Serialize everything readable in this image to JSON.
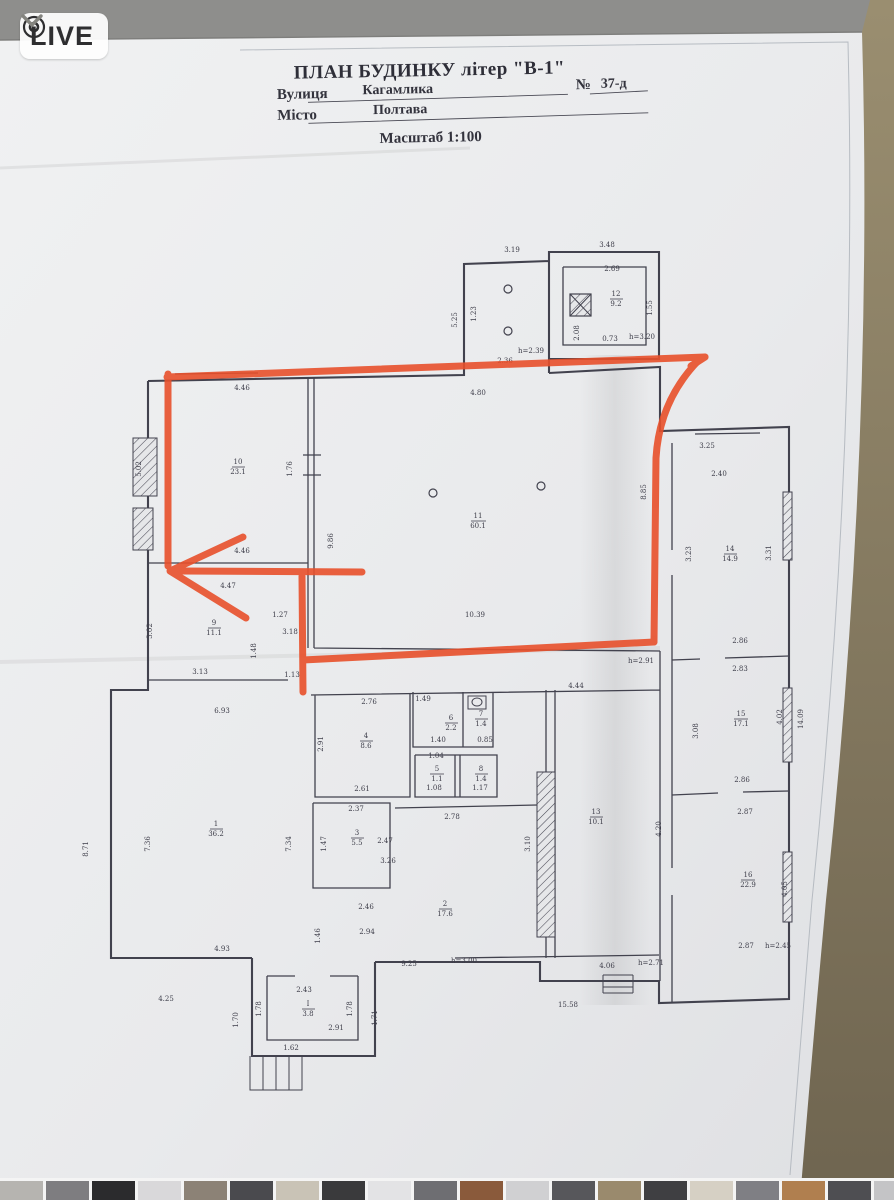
{
  "viewer": {
    "live_label": "LIVE"
  },
  "document": {
    "title": "ПЛАН БУДИНКУ літер \"В-1\"",
    "street_label": "Вулиця",
    "street_value": "Кагамлика",
    "number_label": "№",
    "number_value": "37-д",
    "city_label": "Місто",
    "city_value": "Полтава",
    "scale_label": "Масштаб 1:100"
  },
  "colors": {
    "marker": "#e8502b",
    "paper": "#eceded",
    "background_gray": "#8e8e8c",
    "background_tan": "#8a7d60",
    "ink": "#42424e"
  },
  "plan": {
    "labels": [
      {
        "t": "3.19",
        "x": 512,
        "y": 252
      },
      {
        "t": "3.48",
        "x": 607,
        "y": 247
      },
      {
        "t": "2.69",
        "x": 612,
        "y": 271
      },
      {
        "t": "5.25",
        "x": 457,
        "y": 320,
        "r": -90
      },
      {
        "t": "1.23",
        "x": 476,
        "y": 314,
        "r": -90
      },
      {
        "t": "12",
        "x": 616,
        "y": 296
      },
      {
        "t": "9.2",
        "x": 616,
        "y": 306
      },
      {
        "t": "2.08",
        "x": 579,
        "y": 333,
        "r": -90
      },
      {
        "t": "1.55",
        "x": 652,
        "y": 308,
        "r": -90
      },
      {
        "t": "0.73",
        "x": 610,
        "y": 341
      },
      {
        "t": "h=3.20",
        "x": 642,
        "y": 339
      },
      {
        "t": "h=2.39",
        "x": 531,
        "y": 353
      },
      {
        "t": "2.36",
        "x": 505,
        "y": 363
      },
      {
        "t": "4.46",
        "x": 242,
        "y": 390
      },
      {
        "t": "4.80",
        "x": 478,
        "y": 395
      },
      {
        "t": "1.76",
        "x": 292,
        "y": 469,
        "r": -90
      },
      {
        "t": "10",
        "x": 238,
        "y": 464
      },
      {
        "t": "23.1",
        "x": 238,
        "y": 474
      },
      {
        "t": "9.86",
        "x": 333,
        "y": 541,
        "r": -90
      },
      {
        "t": "8.85",
        "x": 646,
        "y": 492,
        "r": -90
      },
      {
        "t": "11",
        "x": 478,
        "y": 518
      },
      {
        "t": "60.1",
        "x": 478,
        "y": 528
      },
      {
        "t": "10.39",
        "x": 475,
        "y": 617
      },
      {
        "t": "4.46",
        "x": 242,
        "y": 553
      },
      {
        "t": "4.47",
        "x": 228,
        "y": 588
      },
      {
        "t": "9",
        "x": 214,
        "y": 625
      },
      {
        "t": "11.1",
        "x": 214,
        "y": 635
      },
      {
        "t": "5.02",
        "x": 141,
        "y": 469,
        "r": -90
      },
      {
        "t": "3.02",
        "x": 152,
        "y": 631,
        "r": -90
      },
      {
        "t": "1.27",
        "x": 280,
        "y": 617
      },
      {
        "t": "3.18",
        "x": 290,
        "y": 634
      },
      {
        "t": "1.48",
        "x": 256,
        "y": 651,
        "r": -90
      },
      {
        "t": "3.13",
        "x": 200,
        "y": 674
      },
      {
        "t": "1.13",
        "x": 292,
        "y": 677
      },
      {
        "t": "h=2.91",
        "x": 641,
        "y": 663
      },
      {
        "t": "4.44",
        "x": 576,
        "y": 688
      },
      {
        "t": "3.25",
        "x": 707,
        "y": 448
      },
      {
        "t": "2.40",
        "x": 719,
        "y": 476
      },
      {
        "t": "14",
        "x": 730,
        "y": 551
      },
      {
        "t": "14.9",
        "x": 730,
        "y": 561
      },
      {
        "t": "3.23",
        "x": 691,
        "y": 554,
        "r": -90
      },
      {
        "t": "3.31",
        "x": 771,
        "y": 553,
        "r": -90
      },
      {
        "t": "2.86",
        "x": 740,
        "y": 643
      },
      {
        "t": "2.83",
        "x": 740,
        "y": 671
      },
      {
        "t": "15",
        "x": 741,
        "y": 716
      },
      {
        "t": "17.1",
        "x": 741,
        "y": 726
      },
      {
        "t": "3.08",
        "x": 698,
        "y": 731,
        "r": -90
      },
      {
        "t": "4.02",
        "x": 782,
        "y": 717,
        "r": -90
      },
      {
        "t": "14.09",
        "x": 803,
        "y": 719,
        "r": -90
      },
      {
        "t": "2.86",
        "x": 742,
        "y": 782
      },
      {
        "t": "2.87",
        "x": 745,
        "y": 814
      },
      {
        "t": "16",
        "x": 748,
        "y": 877
      },
      {
        "t": "22.9",
        "x": 748,
        "y": 887
      },
      {
        "t": "4.05",
        "x": 787,
        "y": 889,
        "r": -90
      },
      {
        "t": "2.87",
        "x": 746,
        "y": 948
      },
      {
        "t": "h=2.45",
        "x": 778,
        "y": 948
      },
      {
        "t": "2.76",
        "x": 369,
        "y": 704
      },
      {
        "t": "4",
        "x": 366,
        "y": 738
      },
      {
        "t": "8.6",
        "x": 366,
        "y": 748
      },
      {
        "t": "2.91",
        "x": 323,
        "y": 744,
        "r": -90
      },
      {
        "t": "1.49",
        "x": 423,
        "y": 701
      },
      {
        "t": "6",
        "x": 451,
        "y": 720
      },
      {
        "t": "2.2",
        "x": 451,
        "y": 730
      },
      {
        "t": "1.40",
        "x": 438,
        "y": 742
      },
      {
        "t": "7",
        "x": 481,
        "y": 716
      },
      {
        "t": "1.4",
        "x": 481,
        "y": 726
      },
      {
        "t": "0.85",
        "x": 485,
        "y": 742
      },
      {
        "t": "1.04",
        "x": 436,
        "y": 758
      },
      {
        "t": "5",
        "x": 437,
        "y": 771
      },
      {
        "t": "1.1",
        "x": 437,
        "y": 781
      },
      {
        "t": "1.08",
        "x": 434,
        "y": 790
      },
      {
        "t": "8",
        "x": 481,
        "y": 771
      },
      {
        "t": "1.4",
        "x": 481,
        "y": 781
      },
      {
        "t": "1.17",
        "x": 480,
        "y": 790
      },
      {
        "t": "2.61",
        "x": 362,
        "y": 791
      },
      {
        "t": "2.37",
        "x": 356,
        "y": 811
      },
      {
        "t": "13",
        "x": 596,
        "y": 814
      },
      {
        "t": "10.1",
        "x": 596,
        "y": 824
      },
      {
        "t": "4.20",
        "x": 661,
        "y": 829,
        "r": -90
      },
      {
        "t": "3.10",
        "x": 530,
        "y": 844,
        "r": -90
      },
      {
        "t": "2.78",
        "x": 452,
        "y": 819
      },
      {
        "t": "3",
        "x": 357,
        "y": 835
      },
      {
        "t": "5.5",
        "x": 357,
        "y": 845
      },
      {
        "t": "2.47",
        "x": 385,
        "y": 843
      },
      {
        "t": "1.47",
        "x": 326,
        "y": 844,
        "r": -90
      },
      {
        "t": "3.26",
        "x": 388,
        "y": 863
      },
      {
        "t": "2",
        "x": 445,
        "y": 906
      },
      {
        "t": "17.6",
        "x": 445,
        "y": 916
      },
      {
        "t": "2.46",
        "x": 366,
        "y": 909
      },
      {
        "t": "2.94",
        "x": 367,
        "y": 934
      },
      {
        "t": "1.46",
        "x": 320,
        "y": 936,
        "r": -90
      },
      {
        "t": "6.93",
        "x": 222,
        "y": 713
      },
      {
        "t": "7.36",
        "x": 150,
        "y": 844,
        "r": -90
      },
      {
        "t": "1",
        "x": 216,
        "y": 826
      },
      {
        "t": "36.2",
        "x": 216,
        "y": 836
      },
      {
        "t": "4.93",
        "x": 222,
        "y": 951
      },
      {
        "t": "7.34",
        "x": 291,
        "y": 844,
        "r": -90
      },
      {
        "t": "8.71",
        "x": 88,
        "y": 849,
        "r": -90
      },
      {
        "t": "4.25",
        "x": 166,
        "y": 1001
      },
      {
        "t": "1.70",
        "x": 238,
        "y": 1020,
        "r": -90
      },
      {
        "t": "1.78",
        "x": 261,
        "y": 1009,
        "r": -90
      },
      {
        "t": "2.43",
        "x": 304,
        "y": 992
      },
      {
        "t": "І",
        "x": 308,
        "y": 1006
      },
      {
        "t": "3.8",
        "x": 308,
        "y": 1016
      },
      {
        "t": "1.78",
        "x": 352,
        "y": 1009,
        "r": -90
      },
      {
        "t": "2.91",
        "x": 336,
        "y": 1030
      },
      {
        "t": "1.62",
        "x": 291,
        "y": 1050
      },
      {
        "t": "1.71",
        "x": 377,
        "y": 1018,
        "r": -90
      },
      {
        "t": "9.25",
        "x": 409,
        "y": 966
      },
      {
        "t": "h=3.00",
        "x": 464,
        "y": 963
      },
      {
        "t": "4.06",
        "x": 607,
        "y": 968
      },
      {
        "t": "h=2.71",
        "x": 651,
        "y": 965
      },
      {
        "t": "15.58",
        "x": 568,
        "y": 1007
      }
    ]
  },
  "filmstrip": {
    "thumbs": [
      "#b6b4b0",
      "#7e7d80",
      "#2b2b2d",
      "#d9d8da",
      "#8c8276",
      "#4a4a4e",
      "#c9c3b6",
      "#3a3a3c",
      "#e3e3e5",
      "#6e6e72",
      "#8a5a3b",
      "#d0d0d2",
      "#57575b",
      "#9a8a6d",
      "#3f3f42",
      "#d6d0c4",
      "#7f7f84",
      "#b07f4f",
      "#4e4e52",
      "#c4c4c6"
    ]
  }
}
